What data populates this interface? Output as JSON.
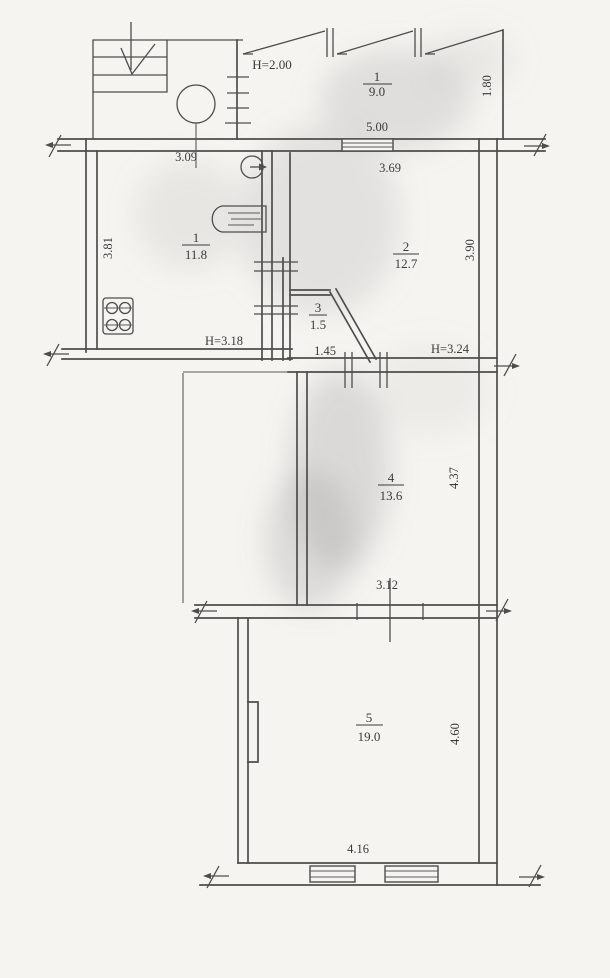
{
  "document": {
    "type": "apartment floor plan (technical inventory drawing)",
    "background_color": "#f6f4f0",
    "line_color": "#4d4d4d",
    "text_color": "#3b3b3b"
  },
  "rooms": [
    {
      "id": "balcony",
      "number": "1",
      "area": "9.0"
    },
    {
      "id": "kitchen",
      "number": "1",
      "area": "11.8"
    },
    {
      "id": "room2",
      "number": "2",
      "area": "12.7"
    },
    {
      "id": "room3",
      "number": "3",
      "area": "1.5"
    },
    {
      "id": "room4",
      "number": "4",
      "area": "13.6"
    },
    {
      "id": "room5",
      "number": "5",
      "area": "19.0"
    }
  ],
  "ceiling_heights": {
    "balcony": "H=2.00",
    "kitchen": "H=3.18",
    "room2": "H=3.24"
  },
  "dimensions": {
    "landing_width": "3.09",
    "balcony_width": "5.00",
    "balcony_depth": "1.80",
    "room2_width": "3.69",
    "room2_depth": "3.90",
    "kitchen_depth": "3.81",
    "room3_width": "1.45",
    "room4_width": "3.12",
    "room4_depth": "4.37",
    "room5_width": "4.16",
    "room5_depth": "4.60"
  },
  "symbols": [
    "staircase-down-arrow",
    "column-circle",
    "gas-water-heater",
    "kitchen-sink",
    "gas-stove-4-burner",
    "window",
    "wall-break-mark"
  ]
}
